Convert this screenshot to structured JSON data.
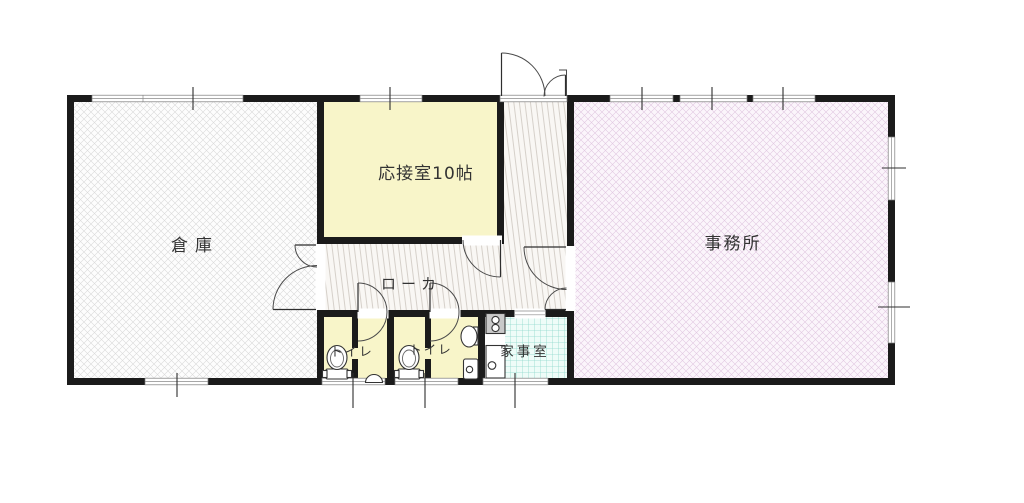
{
  "plan": {
    "type": "floor-plan",
    "rooms": {
      "warehouse": {
        "label": "倉庫"
      },
      "reception": {
        "label": "応接室10帖"
      },
      "corridor": {
        "label": "ローカ"
      },
      "office": {
        "label": "事務所"
      },
      "toilet_1": {
        "label": "トイレ"
      },
      "toilet_2": {
        "label": "トイレ"
      },
      "utility": {
        "label": "家事室"
      }
    },
    "fixtures": [
      "toilet",
      "toilet",
      "urinal",
      "hand-sink",
      "mop-sink",
      "stove",
      "kitchen-sink"
    ],
    "doors": [
      "entrance-double-door",
      "warehouse-double-door",
      "reception-door",
      "office-double-door",
      "toilet-1-door",
      "toilet-2-door",
      "utility-opening"
    ],
    "colors": {
      "wall": "#1b1b1b",
      "room_yellow": "#f8f5c9",
      "warehouse_hatch": "#d8d8d8",
      "office_hatch": "#e0c6e0",
      "corridor_stripe": "#d2ccc5",
      "utility_grid": "#8fd9cc",
      "line": "#333333"
    }
  }
}
